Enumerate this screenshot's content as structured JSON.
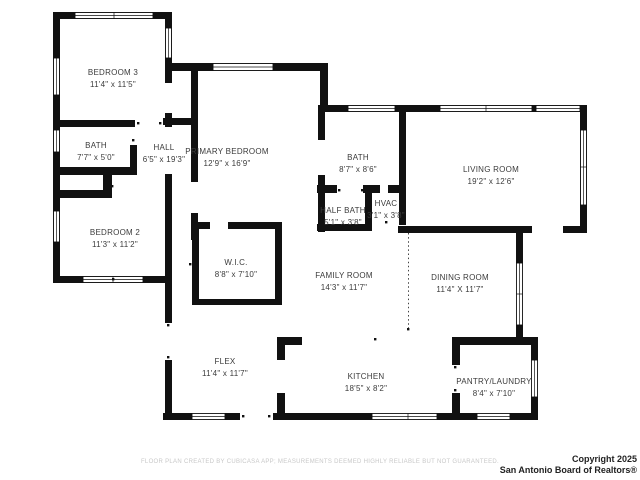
{
  "rooms": [
    {
      "name": "BEDROOM 3",
      "dims": "11'4\" x 11'5\""
    },
    {
      "name": "BATH",
      "dims": "7'7\" x 5'0\""
    },
    {
      "name": "HALL",
      "dims": "6'5\" x 19'3\""
    },
    {
      "name": "PRIMARY BEDROOM",
      "dims": "12'9\" x 16'9\""
    },
    {
      "name": "BATH",
      "dims": "8'7\" x 8'6\""
    },
    {
      "name": "LIVING ROOM",
      "dims": "19'2\" x 12'6\""
    },
    {
      "name": "HALF BATH",
      "dims": "5'1\" x 3'8\""
    },
    {
      "name": "HVAC",
      "dims": "3'1\" x 3'8\""
    },
    {
      "name": "BEDROOM 2",
      "dims": "11'3\" x 11'2\""
    },
    {
      "name": "W.I.C.",
      "dims": "8'8\" x 7'10\""
    },
    {
      "name": "FAMILY ROOM",
      "dims": "14'3\" x 11'7\""
    },
    {
      "name": "DINING ROOM",
      "dims": "11'4\" X 11'7\""
    },
    {
      "name": "FLEX",
      "dims": "11'4\" x 11'7\""
    },
    {
      "name": "KITCHEN",
      "dims": "18'5\" x 8'2\""
    },
    {
      "name": "PANTRY/LAUNDRY",
      "dims": "8'4\" x 7'10\""
    }
  ],
  "footer": {
    "disclaimer": "FLOOR PLAN CREATED BY CUBICASA APP; MEASUREMENTS DEEMED HIGHLY RELIABLE BUT NOT GUARANTEED.",
    "copyright_line1": "Copyright 2025",
    "copyright_line2": "San Antonio Board of Realtors®"
  },
  "colors": {
    "wall": "#111111",
    "label": "#3b3b3b",
    "disclaimer": "#c8c8c8",
    "copyright": "#222222"
  }
}
